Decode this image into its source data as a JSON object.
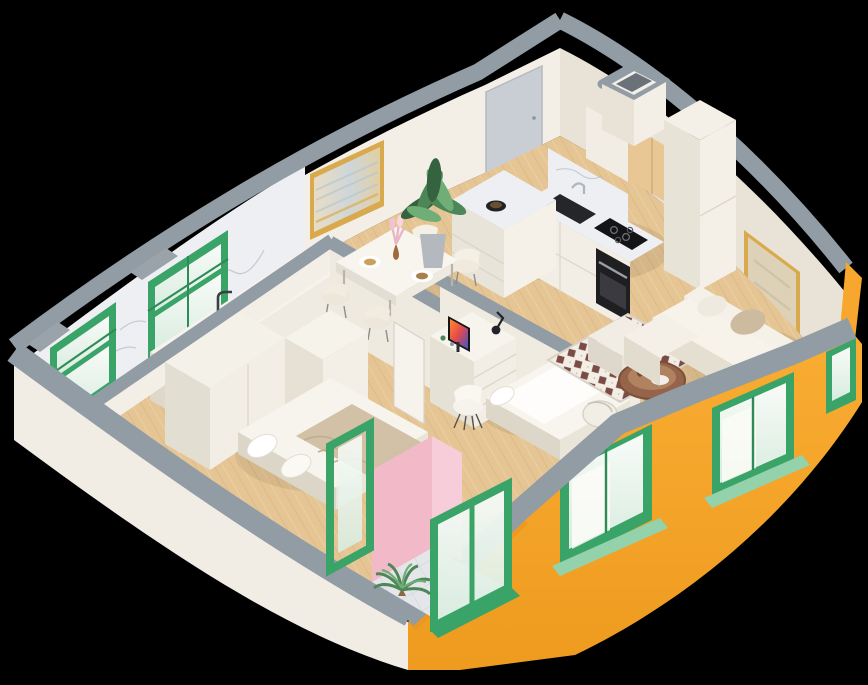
{
  "scene": {
    "kind": "isometric-apartment-floorplan-render",
    "background": "#000000",
    "rooms": [
      "bathroom",
      "hallway",
      "kitchen",
      "living-dining",
      "bedroom-1",
      "bedroom-2",
      "balcony"
    ],
    "objects": [
      "marble-bathroom-wall",
      "green-frame-window",
      "seascape-painting",
      "entry-door",
      "potted-plant",
      "kitchen-counter",
      "kitchen-sink",
      "induction-hob",
      "built-in-oven",
      "wood-upper-cabinet",
      "tall-cabinet",
      "vent-shaft",
      "dining-table",
      "dining-chair",
      "pampas-vase",
      "work-desk",
      "desktop-monitor",
      "desk-lamp",
      "eames-chair",
      "single-bed",
      "double-bed",
      "wardrobe",
      "sofa",
      "ottoman",
      "geometric-rug",
      "round-coffee-table",
      "abstract-painting",
      "pink-balcony-wall",
      "palm-plant",
      "green-glazing",
      "orange-facade",
      "vanity-counter",
      "faucet"
    ]
  },
  "palette": {
    "bg": "#000000",
    "wallTop": "#929ca4",
    "wallTopLight": "#adb6bd",
    "creamExt": "#f1ede4",
    "creamInt": "#e9e3d7",
    "creamInt2": "#f3efe7",
    "orange": "#f7a72e",
    "orangeShade": "#e8941d",
    "green": "#3aa368",
    "greenDark": "#2e8a56",
    "greenLight": "#93d2aa",
    "glass": "#eef6f0",
    "wood": "#e6c595",
    "woodLine": "#d0a974",
    "marble": "#edeff2",
    "marbleVein": "#b7bec9",
    "pink": "#f2bac9",
    "tile": "#e4e6e9",
    "white": "#f6f3ec",
    "whiteShade": "#ded8cb",
    "whiteDark": "#cfc8ba",
    "tan": "#cdbb9f",
    "rugBase": "#f2ede5",
    "rugAccent": "#6e3b34",
    "tableWood": "#96644a",
    "tableWoodLight": "#b08260",
    "cabinetWood": "#e8c795",
    "black": "#1f1f22",
    "gold": "#d9a94e",
    "art": "#ddd2b8",
    "artBlue": "#b9c6cf",
    "plant": "#4e8757",
    "plantDark": "#35633f",
    "plantLight": "#6fae76",
    "metal": "#c7ccd2",
    "doorGray": "#c9ced4"
  }
}
